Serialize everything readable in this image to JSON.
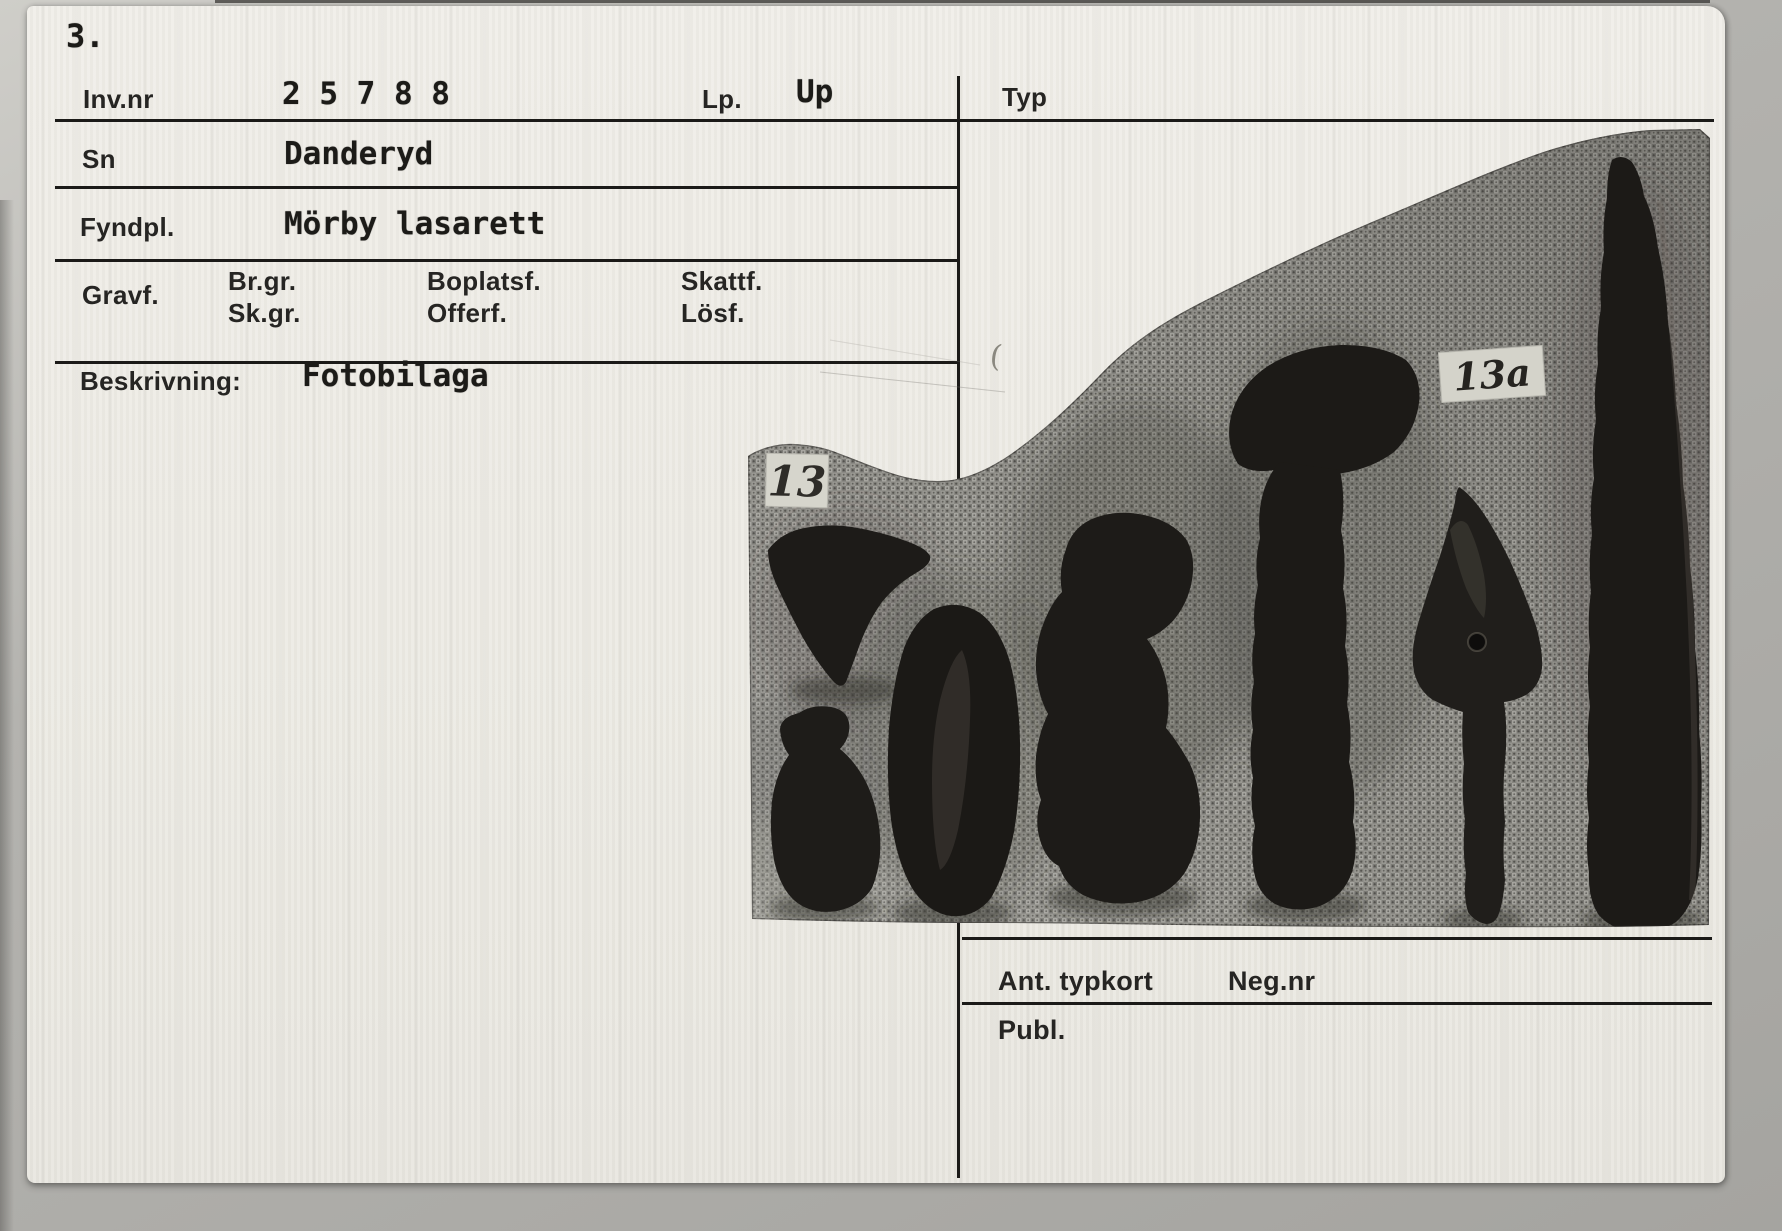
{
  "card": {
    "page_number": "3.",
    "fields": {
      "inv_nr": {
        "label": "Inv.nr",
        "value": "2 5 7 8 8"
      },
      "lp": {
        "label": "Lp.",
        "value": "Up"
      },
      "typ": {
        "label": "Typ",
        "value": ""
      },
      "sn": {
        "label": "Sn",
        "value": "Danderyd"
      },
      "fyndpl": {
        "label": "Fyndpl.",
        "value": "Mörby lasarett"
      },
      "gravf": {
        "label": "Gravf.",
        "sub_labels": [
          "Br.gr.",
          "Sk.gr.",
          "Boplatsf.",
          "Offerf.",
          "Skattf.",
          "Lösf."
        ]
      },
      "beskrivning": {
        "label": "Beskrivning:",
        "value": "Fotobilaga"
      },
      "ant_typkort": {
        "label": "Ant. typkort",
        "value": ""
      },
      "neg_nr": {
        "label": "Neg.nr",
        "value": ""
      },
      "publ": {
        "label": "Publ.",
        "value": ""
      }
    },
    "stray_mark": "("
  },
  "photo": {
    "tag_left": "13",
    "tag_right": "13a",
    "artifact_count": 7
  },
  "colors": {
    "card_paper": "#ECEAE3",
    "scanner_background": "#ADACA8",
    "ruled_line": "#1B1A18",
    "fabric_base": "#908F8A",
    "artifact_iron": "#1D1B18",
    "tag_paper": "#D6D5CC"
  }
}
